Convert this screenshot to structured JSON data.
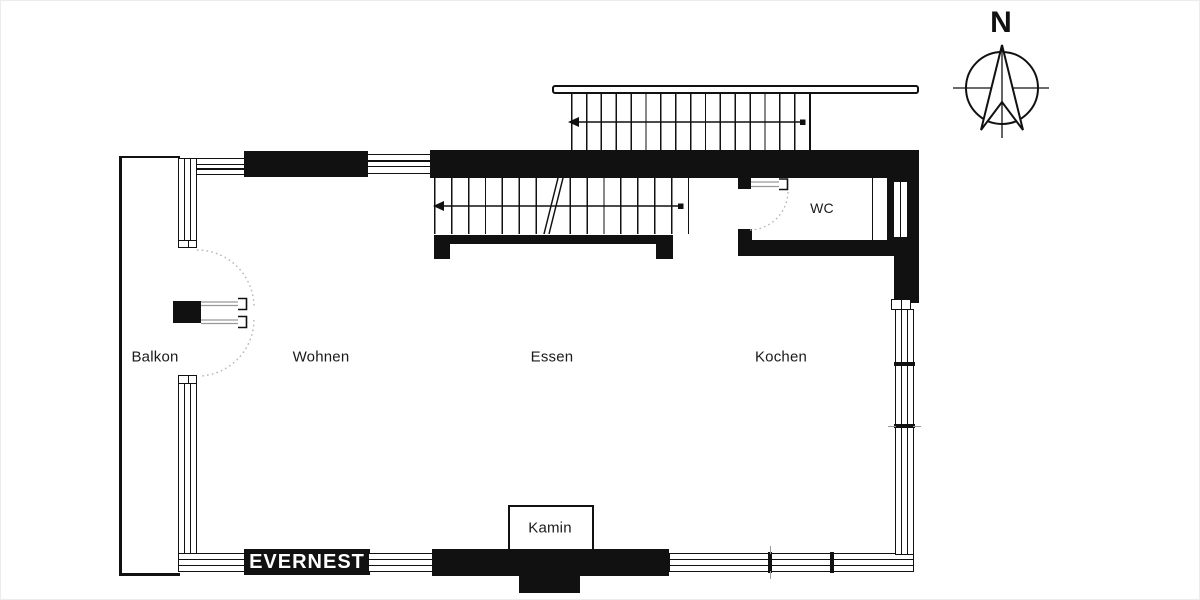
{
  "compass": {
    "north_label": "N"
  },
  "brand": {
    "logo_text": "EVERNEST"
  },
  "rooms": {
    "balkon": "Balkon",
    "wohnen": "Wohnen",
    "essen": "Essen",
    "kochen": "Kochen",
    "wc": "WC"
  },
  "features": {
    "kamin": "Kamin"
  },
  "colors": {
    "wall": "#111111",
    "text": "#1a1a1a",
    "door_leaf": "#999999",
    "swing_arc_dotted": "#b5b5b5",
    "background": "#ffffff"
  }
}
